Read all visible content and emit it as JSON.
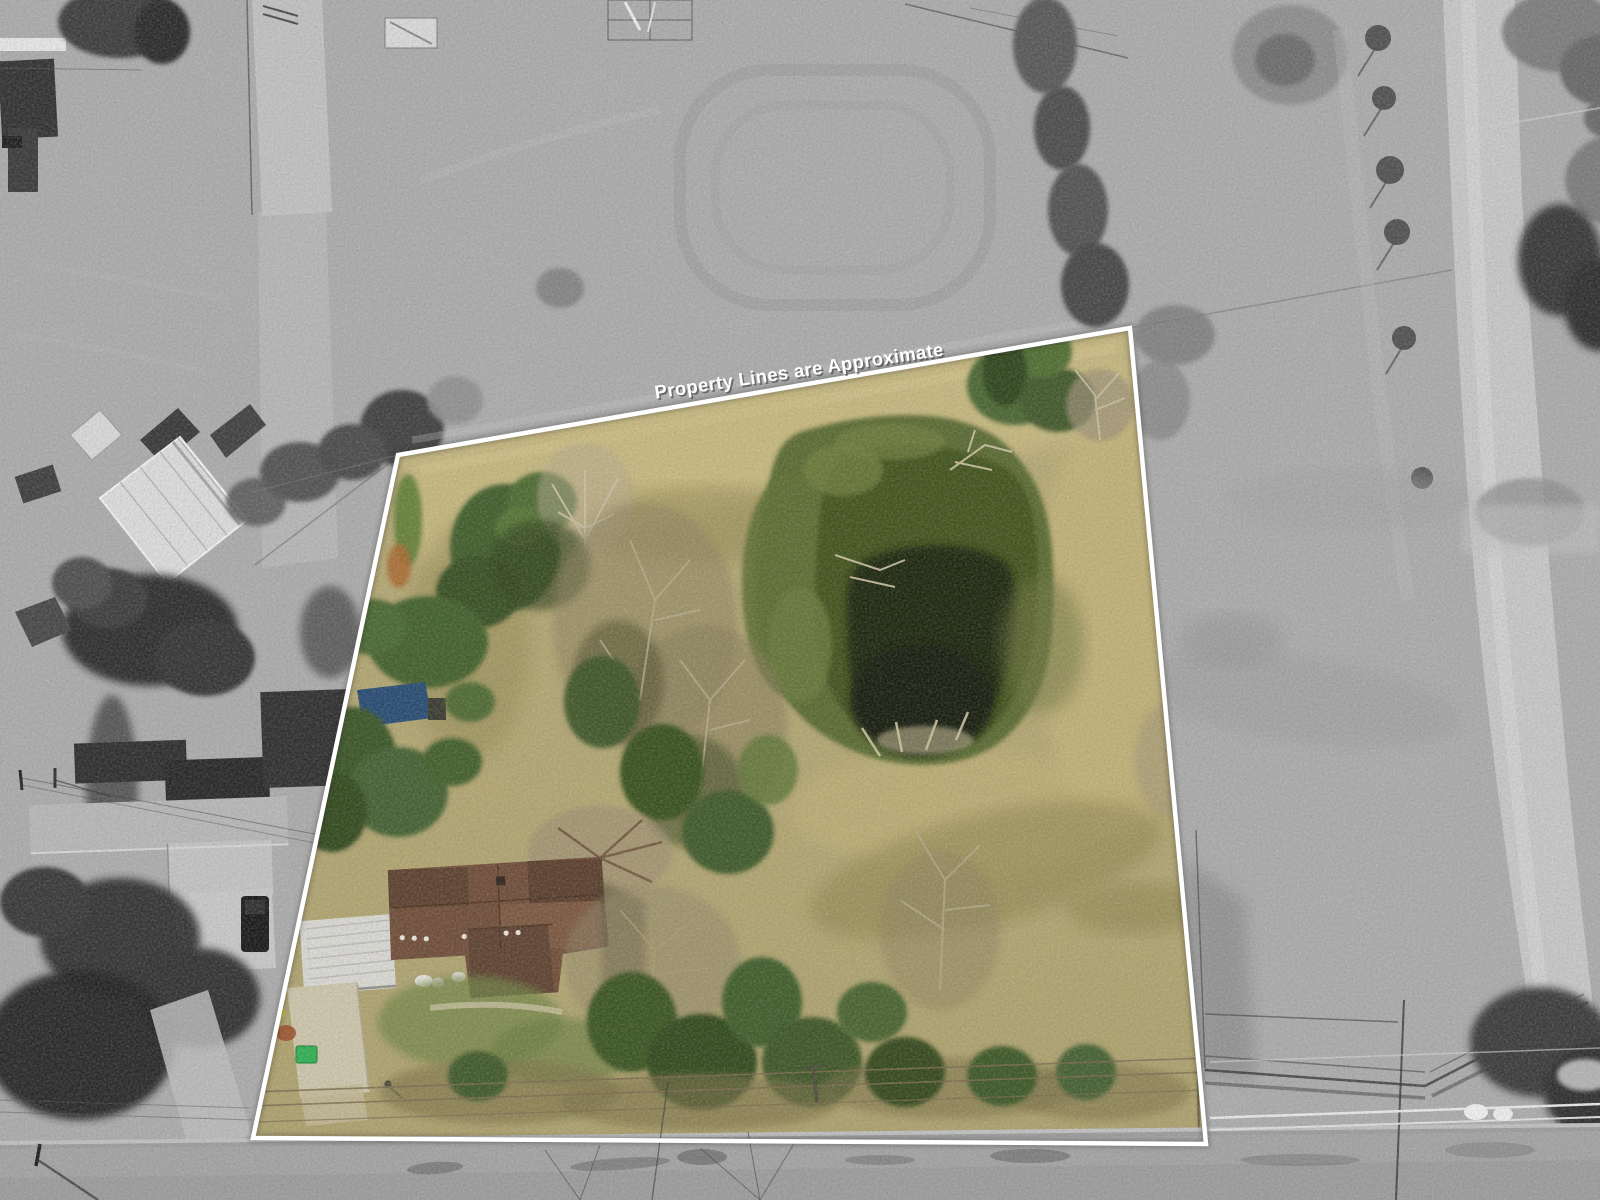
{
  "overlay": {
    "disclaimer_text": "Property Lines are Approximate",
    "boundary_color": "#ffffff",
    "text_color": "#ffffff",
    "polygon_points": "398,455 1130,328 1206,1144 253,1138"
  },
  "scene": {
    "palette": {
      "surroundings_grayscale": "#acacac",
      "road_asphalt": "#9c9c9c",
      "dirt_road": "#c7c7c7",
      "field_tan": "#b5a770",
      "pond_dark": "#1c2610",
      "pond_mid": "#42531f",
      "pond_algae": "#5a6b30",
      "tree_green": "#3f5a29",
      "bare_tree": "#9b8d72",
      "house_roof_brown": "#6f4d38",
      "carport_metal": "#d9d8d3",
      "driveway_concrete": "#cdc5ab",
      "trash_bin_green": "#2fb052",
      "tarp_blue": "#274b72",
      "barn_roof_white": "#dcdcdc"
    }
  }
}
